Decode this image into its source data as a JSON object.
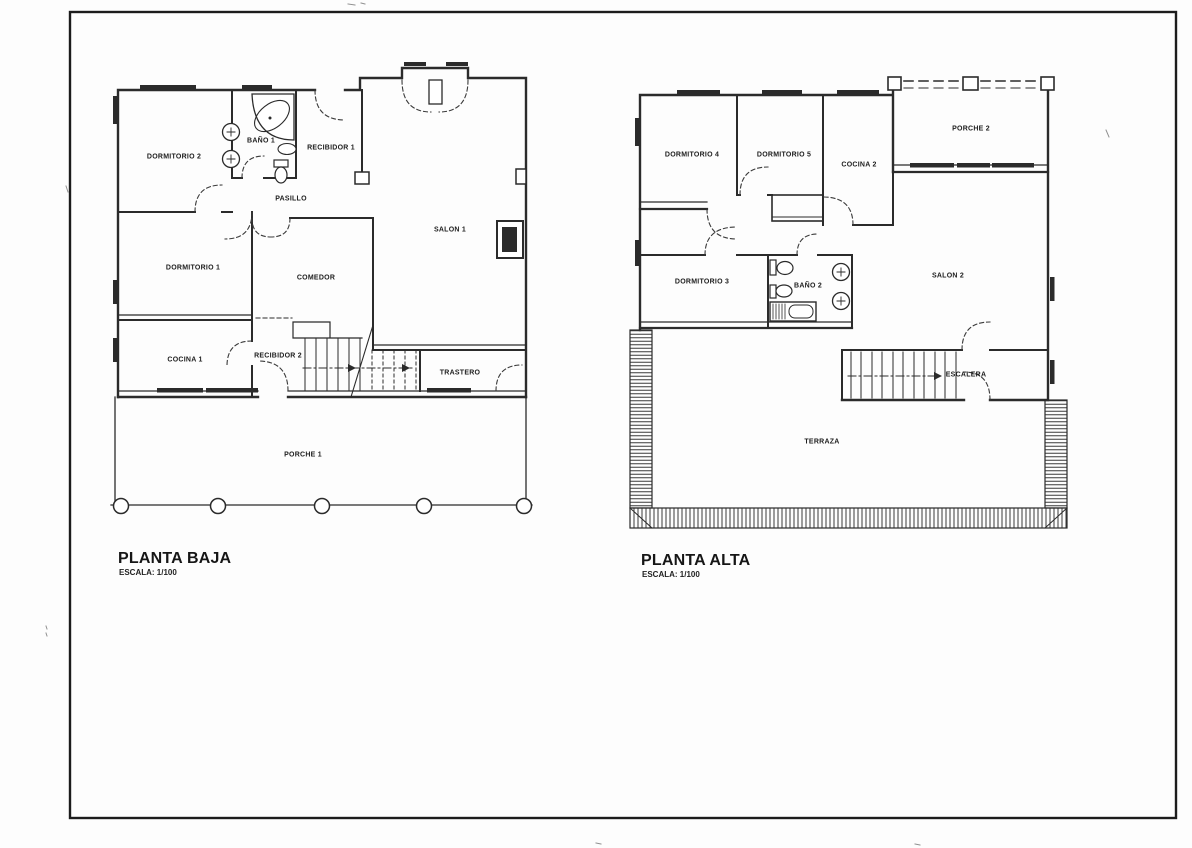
{
  "sheet": {
    "background": "#fdfdfd",
    "border_color": "#1c1c1c",
    "line_color": "#2b2b2b"
  },
  "plans": {
    "planta_baja": {
      "title": "PLANTA BAJA",
      "scale_label": "ESCALA: 1/100",
      "rooms": {
        "dormitorio2": "DORMITORIO 2",
        "bano1": "BAÑO 1",
        "recibidor1": "RECIBIDOR 1",
        "pasillo": "PASILLO",
        "salon1": "SALON 1",
        "dormitorio1": "DORMITORIO 1",
        "comedor": "COMEDOR",
        "cocina1": "COCINA 1",
        "recibidor2": "RECIBIDOR 2",
        "trastero": "TRASTERO",
        "porche1": "PORCHE 1"
      }
    },
    "planta_alta": {
      "title": "PLANTA ALTA",
      "scale_label": "ESCALA: 1/100",
      "rooms": {
        "dormitorio4": "DORMITORIO 4",
        "dormitorio5": "DORMITORIO 5",
        "cocina2": "COCINA 2",
        "porche2": "PORCHE 2",
        "dormitorio3": "DORMITORIO 3",
        "bano2": "BAÑO 2",
        "salon2": "SALON 2",
        "escalera": "ESCALERA",
        "terraza": "TERRAZA"
      }
    }
  }
}
